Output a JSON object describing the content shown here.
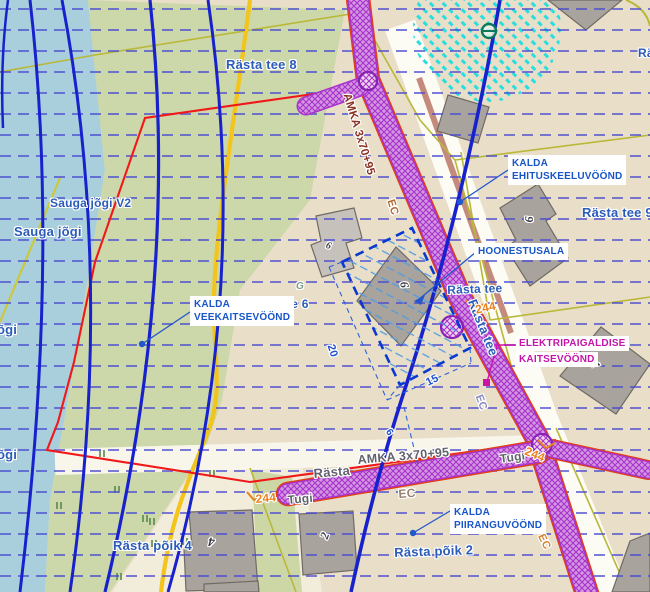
{
  "map": {
    "callouts": {
      "ehituskeeluvoond": {
        "line1": "KALDA",
        "line2": "EHITUSKEELUVÖÖND"
      },
      "hoonestusala": {
        "line1": "HOONESTUSALA"
      },
      "veekaitsevoond": {
        "line1": "KALDA",
        "line2": "VEEKAITSEVÖÖND"
      },
      "elektripaigaldise": {
        "line1": "ELEKTRIPAIGALDISE",
        "line2": "KAITSEVÖÖND"
      },
      "piiranguvoond": {
        "line1": "KALDA",
        "line2": "PIIRANGUVÖÖND"
      }
    },
    "labels": [
      {
        "name": "street-label-rasta-tee-8",
        "t": "Rästa tee 8",
        "x": 226,
        "y": 57,
        "r": 0,
        "c": "st",
        "fs": 13
      },
      {
        "name": "street-label-ra-partial",
        "t": "Rä",
        "x": 638,
        "y": 46,
        "r": 0,
        "c": "st",
        "fs": 12
      },
      {
        "name": "street-label-rasta-tee-9",
        "t": "Rästa tee 9",
        "x": 582,
        "y": 205,
        "r": 0,
        "c": "st",
        "fs": 13
      },
      {
        "name": "street-label-rasta-tee-h",
        "t": "Rästa tee",
        "x": 447,
        "y": 283,
        "r": -2,
        "c": "st",
        "fs": 12
      },
      {
        "name": "street-label-rasta-tee-6",
        "t": "Rästa tee 6",
        "x": 243,
        "y": 297,
        "r": 0,
        "c": "st",
        "fs": 12
      },
      {
        "name": "street-label-rasta-tee-v",
        "t": "Rästa tee",
        "x": 479,
        "y": 297,
        "r": 68,
        "c": "st",
        "fs": 13
      },
      {
        "name": "water-label-sauga-jogi-v2",
        "t": "Sauga jõgi V2",
        "x": 50,
        "y": 196,
        "r": 0,
        "c": "st",
        "fs": 12
      },
      {
        "name": "water-label-sauga-jogi",
        "t": "Sauga jõgi",
        "x": 14,
        "y": 224,
        "r": 0,
        "c": "st",
        "fs": 13
      },
      {
        "name": "water-label-jogi-1",
        "t": "õgi",
        "x": -3,
        "y": 322,
        "r": 0,
        "c": "st",
        "fs": 13
      },
      {
        "name": "water-label-jogi-2",
        "t": "õgi",
        "x": -3,
        "y": 447,
        "r": 0,
        "c": "st",
        "fs": 13
      },
      {
        "name": "street-label-rasta-poik-4",
        "t": "Rästa põik 4",
        "x": 113,
        "y": 538,
        "r": 0,
        "c": "st",
        "fs": 13
      },
      {
        "name": "street-label-rasta-poik-2",
        "t": "Rästa põik 2",
        "x": 394,
        "y": 545,
        "r": -2,
        "c": "st",
        "fs": 13
      },
      {
        "name": "cable-label-amka-top",
        "t": "AMKA 3x70+95",
        "x": 352,
        "y": 92,
        "r": 73,
        "c": "amka",
        "fs": 11.5
      },
      {
        "name": "cable-label-amka-bottom",
        "t": "AMKA 3x70+95",
        "x": 357,
        "y": 453,
        "r": -5,
        "c": "g2",
        "fs": 12.5
      },
      {
        "name": "street-label-rasta-bottom",
        "t": "Rästa",
        "x": 313,
        "y": 466,
        "r": -5,
        "c": "g2",
        "fs": 13
      },
      {
        "name": "cable-label-ec-top",
        "t": "EC",
        "x": 396,
        "y": 198,
        "r": 73,
        "c": "ec1",
        "fs": 11
      },
      {
        "name": "cable-label-ec-mid",
        "t": "EC",
        "x": 484,
        "y": 393,
        "r": 70,
        "c": "ec2",
        "fs": 11
      },
      {
        "name": "cable-label-ec-bottom",
        "t": "EC",
        "x": 398,
        "y": 487,
        "r": -4,
        "c": "ec3",
        "fs": 12
      },
      {
        "name": "cable-label-ec-right",
        "t": "EC",
        "x": 546,
        "y": 532,
        "r": 64,
        "c": "ec4",
        "fs": 11
      },
      {
        "name": "support-label-tugi-left",
        "t": "Tugi",
        "x": 287,
        "y": 493,
        "r": -5,
        "c": "g2",
        "fs": 12
      },
      {
        "name": "support-label-tugi-right",
        "t": "Tugi",
        "x": 499,
        "y": 452,
        "r": -8,
        "c": "g2",
        "fs": 12
      },
      {
        "name": "pole-label-244-left",
        "t": "244",
        "x": 255,
        "y": 492,
        "r": -5,
        "c": "or",
        "fs": 12
      },
      {
        "name": "pole-label-244-mid",
        "t": "244",
        "x": 474,
        "y": 303,
        "r": -12,
        "c": "or",
        "fs": 12
      },
      {
        "name": "pole-label-244-right",
        "t": "244",
        "x": 528,
        "y": 444,
        "r": 22,
        "c": "or",
        "fs": 12
      },
      {
        "name": "dimension-label-20",
        "t": "20",
        "x": 336,
        "y": 343,
        "r": 72,
        "c": "dim",
        "fs": 11
      },
      {
        "name": "dimension-label-15",
        "t": "15",
        "x": 424,
        "y": 378,
        "r": -27,
        "c": "dim",
        "fs": 11
      },
      {
        "name": "dimension-label-6",
        "t": "6",
        "x": 392,
        "y": 427,
        "r": 55,
        "c": "dim",
        "fs": 10
      },
      {
        "name": "building-number-9-rasta9",
        "t": "9",
        "x": 536,
        "y": 216,
        "r": 88,
        "c": "bn",
        "fs": 12
      },
      {
        "name": "building-number-9-center",
        "t": "9",
        "x": 398,
        "y": 289,
        "r": -100,
        "c": "bn",
        "fs": 12
      },
      {
        "name": "building-number-6",
        "t": "6",
        "x": 328,
        "y": 240,
        "r": 20,
        "c": "bn",
        "fs": 10
      },
      {
        "name": "building-number-1",
        "t": "1",
        "x": 602,
        "y": 360,
        "r": 75,
        "c": "bn",
        "fs": 12
      },
      {
        "name": "building-number-4",
        "t": "4",
        "x": 214,
        "y": 550,
        "r": 185,
        "c": "bn",
        "fs": 13
      },
      {
        "name": "building-number-2",
        "t": "2",
        "x": 317,
        "y": 536,
        "r": -70,
        "c": "bn",
        "fs": 12
      },
      {
        "name": "utility-label-g",
        "t": "G",
        "x": 296,
        "y": 281,
        "r": 0,
        "c": "g3",
        "fs": 10
      }
    ],
    "colors": {
      "water": "#a9cfdd",
      "land_green": "#ccd8aa",
      "land_beige": "#e9dfc9",
      "road_white": "#fcfbf4",
      "grid_blue": "#4a4ad0",
      "contour_blue": "#1822cc",
      "boundary_red": "#f01818",
      "cable_purple": "#a832cc",
      "cable_border_orange": "#e04018",
      "cadastral_yellow": "#f2c41c",
      "cadastral_olive": "#b9b839",
      "zone_cyan": "#28dede",
      "building_gray": "#a8a39c",
      "label_blue": "#1856c8",
      "label_magenta": "#c415a8",
      "label_orange": "#e8821e"
    }
  }
}
